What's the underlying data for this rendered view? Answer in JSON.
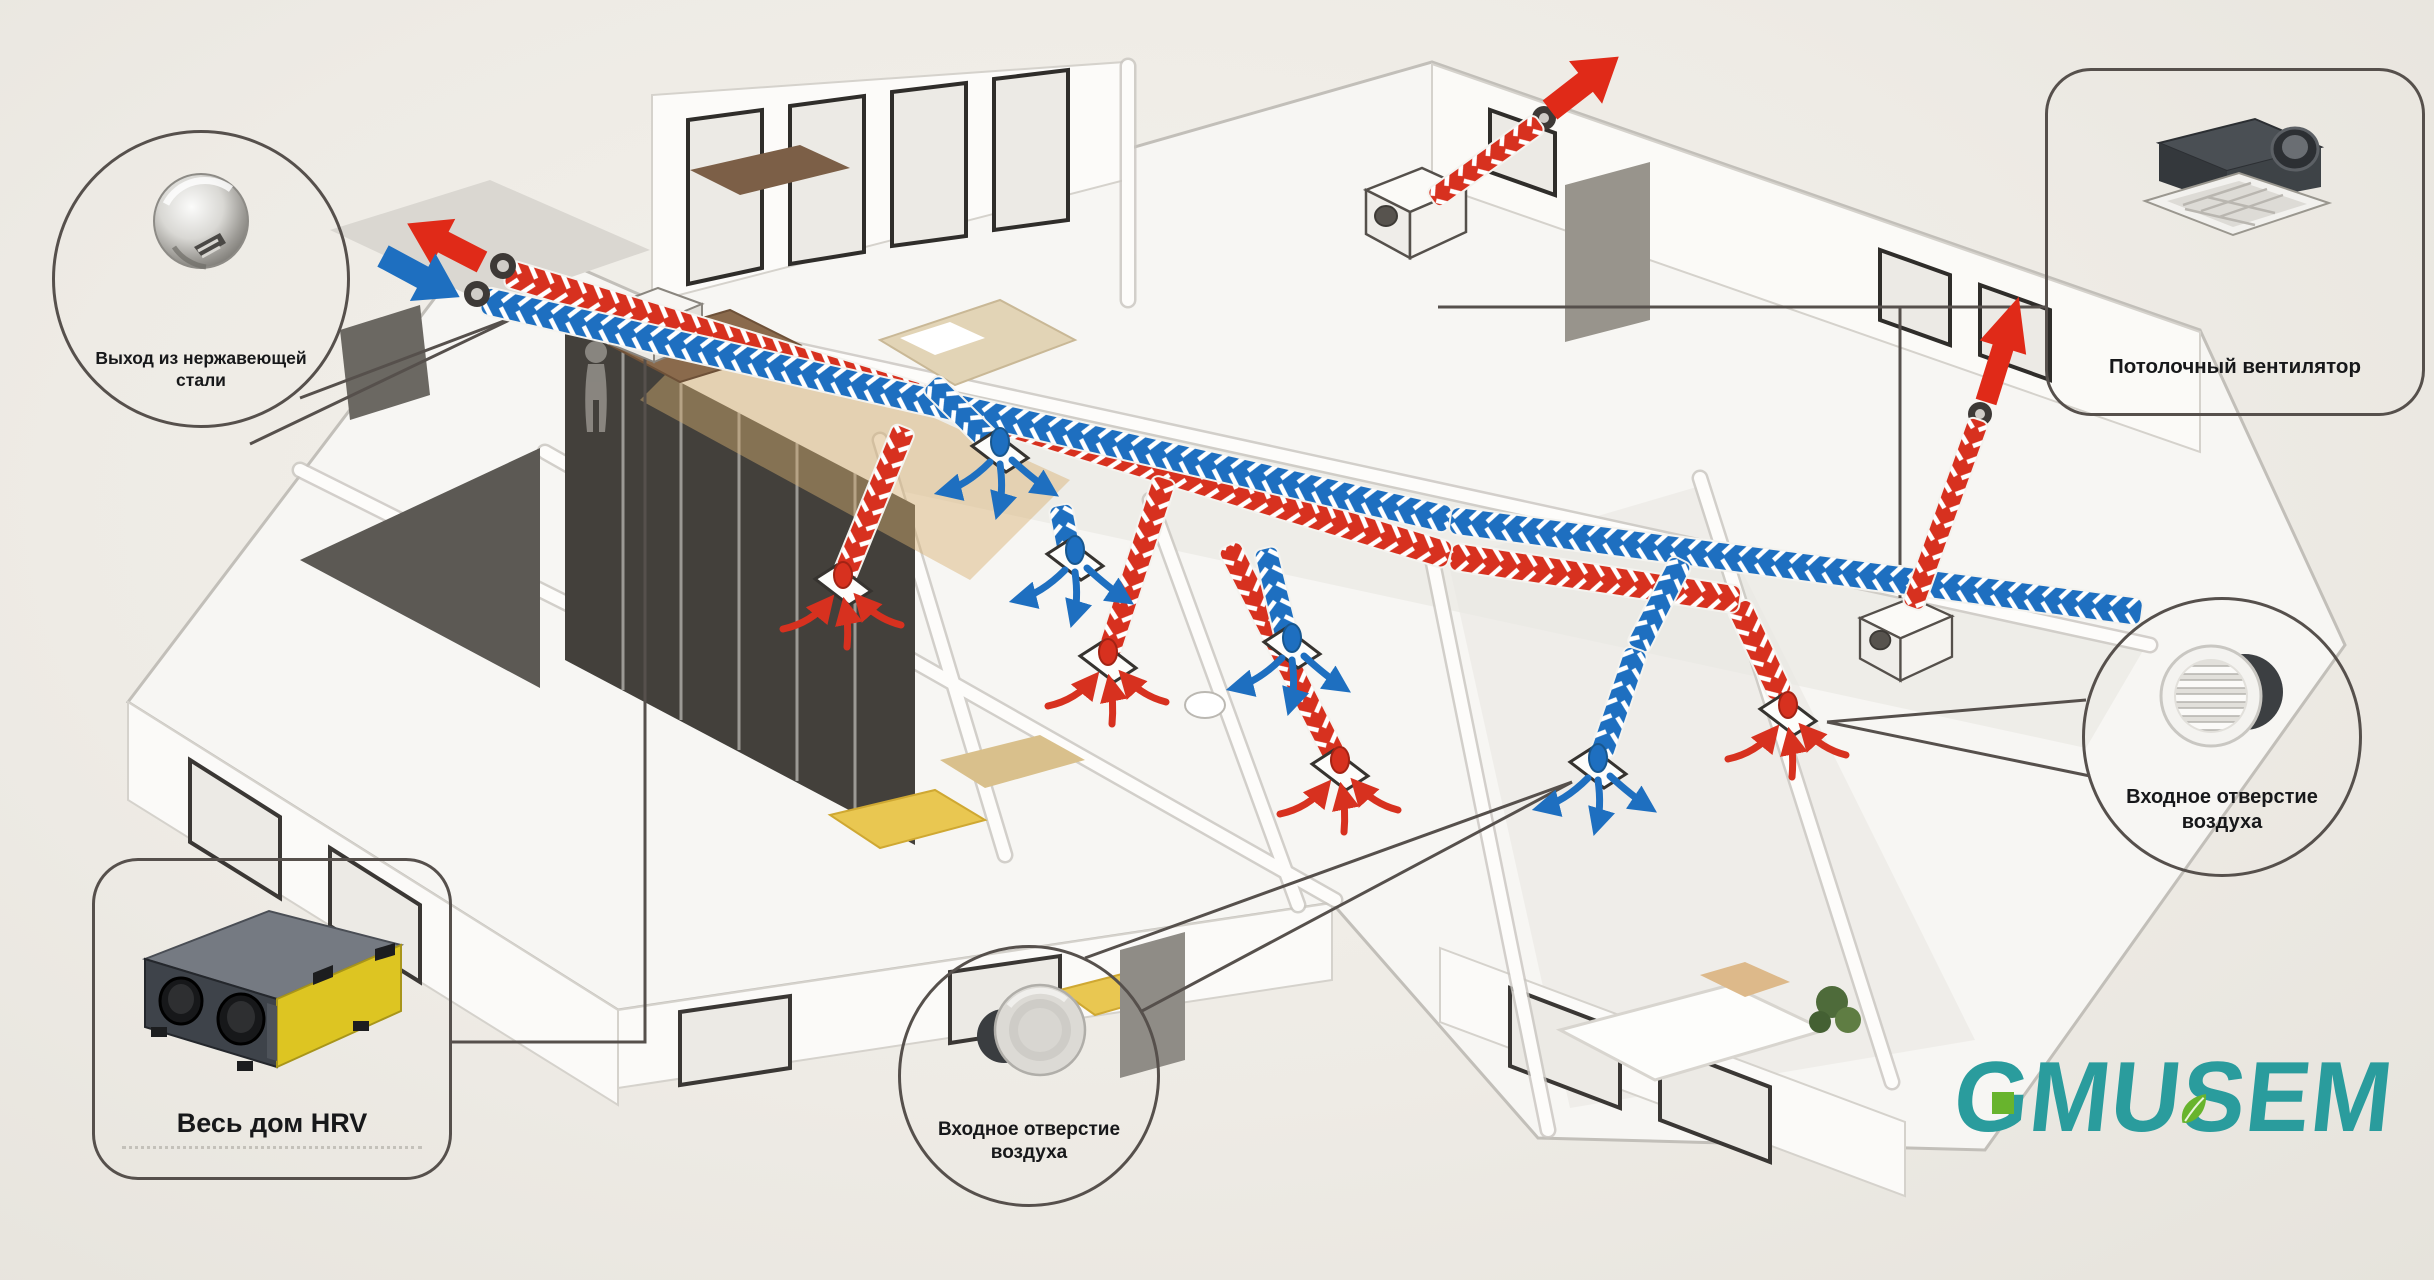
{
  "colors": {
    "exhaust_red": "#d7311f",
    "fresh_blue": "#1e6fc0",
    "outline_dark": "#56504c",
    "logo_teal": "#2a9c9d",
    "logo_green": "#68b42d",
    "hrv_yellow": "#ddc522"
  },
  "callouts": {
    "stainless_outlet": {
      "label": "Выход из нержавеющей стали",
      "icon": "stainless-steel-vent-cap"
    },
    "ceiling_fan": {
      "label": "Потолочный вентилятор",
      "icon": "ceiling-fan-unit"
    },
    "air_inlet_right": {
      "label": "Входное отверстие воздуха",
      "icon": "round-louver-vent"
    },
    "air_inlet_floor": {
      "label": "Входное отверстие воздуха",
      "icon": "disc-air-diffuser"
    },
    "hrv": {
      "label": "Весь дом HRV",
      "icon": "hrv-unit-box"
    }
  },
  "logo": {
    "text": "GMUSEM"
  }
}
